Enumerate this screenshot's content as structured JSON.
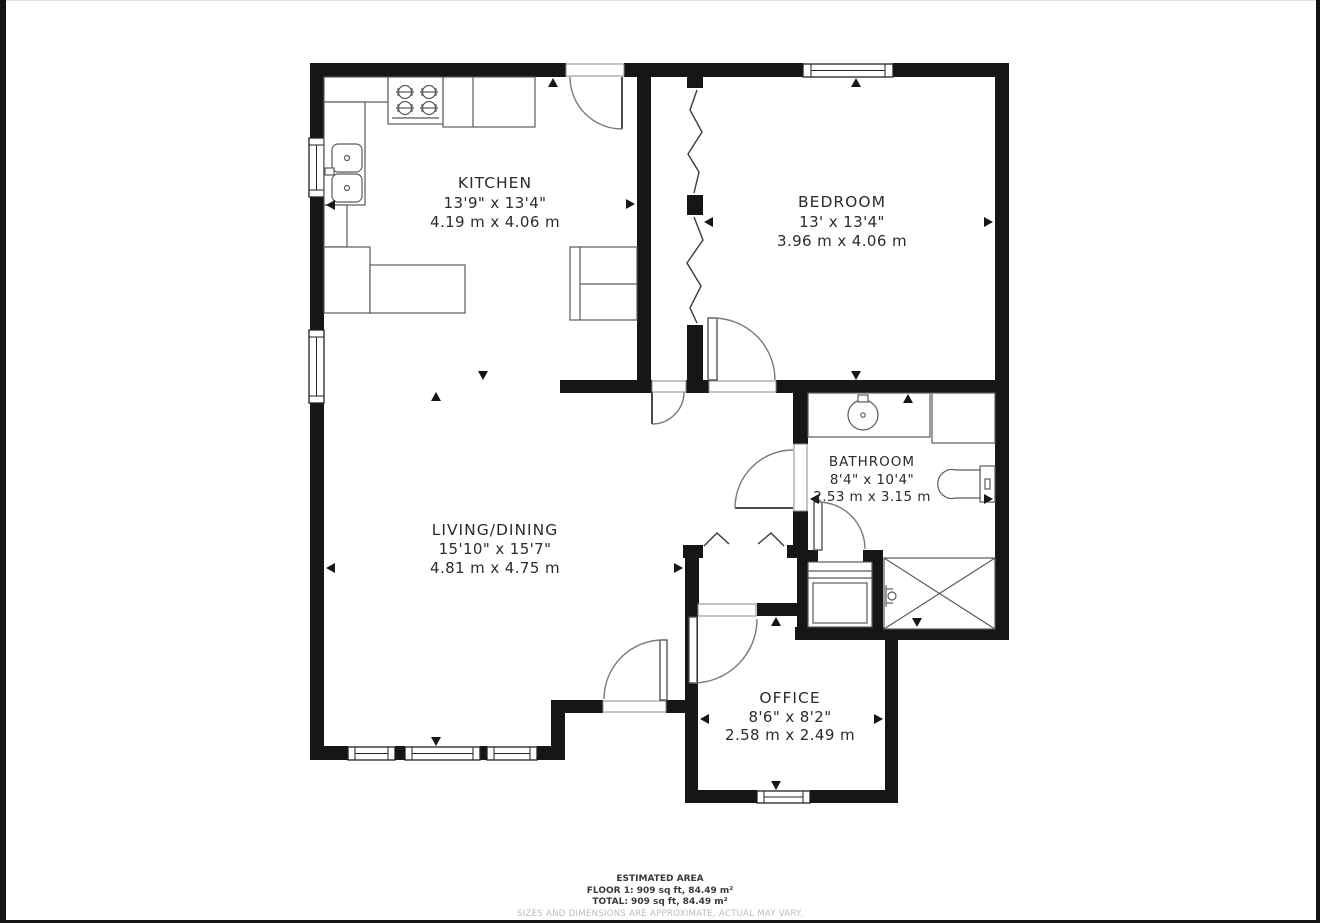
{
  "colors": {
    "wall": "#161616",
    "fixture_line": "#5a5a5a",
    "door_arc": "#7a7a7a",
    "text": "#2b2b2b",
    "muted_text": "#bcbcbc"
  },
  "rooms": [
    {
      "id": "kitchen",
      "name": "KITCHEN",
      "imperial": "13'9\" x 13'4\"",
      "metric": "4.19 m x 4.06 m"
    },
    {
      "id": "bedroom",
      "name": "BEDROOM",
      "imperial": "13' x 13'4\"",
      "metric": "3.96 m x 4.06 m"
    },
    {
      "id": "bathroom",
      "name": "BATHROOM",
      "imperial": "8'4\" x 10'4\"",
      "metric": "2.53 m x 3.15 m"
    },
    {
      "id": "living",
      "name": "LIVING/DINING",
      "imperial": "15'10\" x 15'7\"",
      "metric": "4.81 m x 4.75 m"
    },
    {
      "id": "office",
      "name": "OFFICE",
      "imperial": "8'6\" x 8'2\"",
      "metric": "2.58 m x 2.49 m"
    }
  ],
  "fixtures": [
    "stove-icon",
    "kitchen-sink-icon",
    "refrigerator-icon",
    "bathroom-sink-icon",
    "vanity-cabinet-icon",
    "toilet-icon",
    "washer-icon",
    "shower-icon"
  ],
  "dimension_markers": [
    {
      "x": 553,
      "y": 78,
      "dir": "up"
    },
    {
      "x": 483,
      "y": 380,
      "dir": "down"
    },
    {
      "x": 326,
      "y": 205,
      "dir": "left"
    },
    {
      "x": 635,
      "y": 204,
      "dir": "right"
    },
    {
      "x": 856,
      "y": 78,
      "dir": "up"
    },
    {
      "x": 856,
      "y": 380,
      "dir": "down"
    },
    {
      "x": 704,
      "y": 222,
      "dir": "left"
    },
    {
      "x": 993,
      "y": 222,
      "dir": "right"
    },
    {
      "x": 908,
      "y": 394,
      "dir": "up"
    },
    {
      "x": 917,
      "y": 627,
      "dir": "down"
    },
    {
      "x": 810,
      "y": 499,
      "dir": "left"
    },
    {
      "x": 993,
      "y": 499,
      "dir": "right"
    },
    {
      "x": 436,
      "y": 392,
      "dir": "up"
    },
    {
      "x": 436,
      "y": 746,
      "dir": "down"
    },
    {
      "x": 326,
      "y": 568,
      "dir": "left"
    },
    {
      "x": 683,
      "y": 568,
      "dir": "right"
    },
    {
      "x": 776,
      "y": 617,
      "dir": "up"
    },
    {
      "x": 776,
      "y": 790,
      "dir": "down"
    },
    {
      "x": 700,
      "y": 719,
      "dir": "left"
    },
    {
      "x": 883,
      "y": 719,
      "dir": "right"
    }
  ],
  "footer": {
    "title": "ESTIMATED AREA",
    "floor_line": "FLOOR 1: 909 sq ft, 84.49 m²",
    "total_line": "TOTAL: 909 sq ft, 84.49 m²",
    "disclaimer": "SIZES AND DIMENSIONS ARE APPROXIMATE, ACTUAL MAY VARY."
  }
}
